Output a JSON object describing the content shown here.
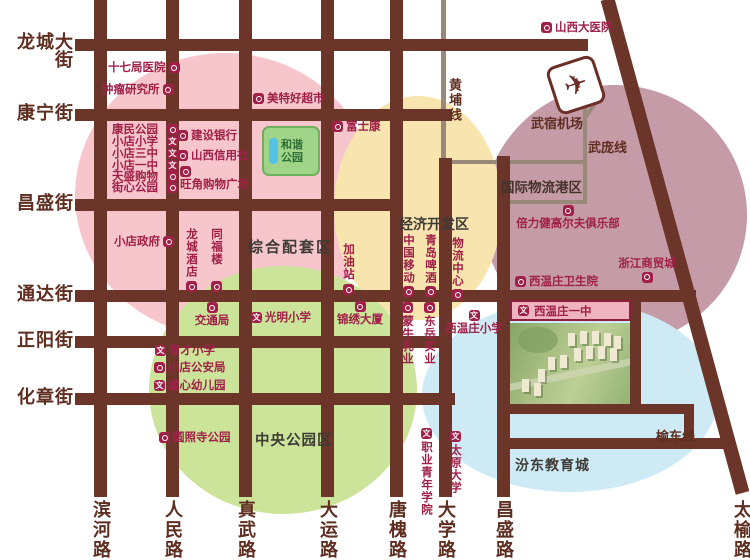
{
  "streets_left": [
    {
      "label": "龙城大街"
    },
    {
      "label": "康宁街"
    },
    {
      "label": "昌盛街"
    },
    {
      "label": "通达街"
    },
    {
      "label": "正阳街"
    },
    {
      "label": "化章街"
    }
  ],
  "roads_bottom": [
    {
      "label": "滨河路"
    },
    {
      "label": "人民路"
    },
    {
      "label": "真武路"
    },
    {
      "label": "大运路"
    },
    {
      "label": "唐槐路"
    },
    {
      "label": "大学路"
    },
    {
      "label": "昌盛路"
    },
    {
      "label": "太榆路"
    }
  ],
  "lines": {
    "huangpu": "黄埔线",
    "wupang": "武庞线",
    "yudong": "榆东线"
  },
  "airport": {
    "label": "武宿机场",
    "icon": "airplane-icon"
  },
  "zones": {
    "composite": {
      "title": "综合配套区",
      "color": "#f7c6cd"
    },
    "economic": {
      "title": "经济开发区",
      "color": "#f7e4ae"
    },
    "logistics": {
      "title": "国际物流港区",
      "color": "#c49ba6"
    },
    "central_park": {
      "title": "中央公园区",
      "color": "#cbe49a"
    },
    "education": {
      "title": "汾东教育城",
      "color": "#cdeaf5"
    }
  },
  "harmony_park": {
    "label": "和谐公园"
  },
  "banner": {
    "label": "西温庄一中",
    "icon": "school-icon"
  },
  "pois": [
    {
      "label": "山西大医院",
      "icon": "hospital-icon"
    },
    {
      "label": "十七局医院",
      "icon": "hospital-icon"
    },
    {
      "label": "肿瘤研究所",
      "icon": "hospital-icon"
    },
    {
      "label": "康民公园",
      "icon": "park-icon"
    },
    {
      "label": "小店小学",
      "icon": "school-icon"
    },
    {
      "label": "小店三中",
      "icon": "school-icon"
    },
    {
      "label": "小店一中",
      "icon": "school-icon"
    },
    {
      "label": "天盛购物",
      "icon": "shopping-icon"
    },
    {
      "label": "街心公园",
      "icon": "park-icon"
    },
    {
      "label": "建设银行",
      "icon": "bank-icon"
    },
    {
      "label": "山西信用社",
      "icon": "bank-icon"
    },
    {
      "label": "旺角购物广场",
      "icon": "shopping-icon"
    },
    {
      "label": "美特好超市",
      "icon": "supermarket-icon"
    },
    {
      "label": "富士康",
      "icon": "company-icon"
    },
    {
      "label": "小店政府",
      "icon": "government-icon"
    },
    {
      "label": "龙城酒店",
      "icon": "hotel-icon"
    },
    {
      "label": "同福楼",
      "icon": "restaurant-icon"
    },
    {
      "label": "加油站",
      "icon": "gas-station-icon"
    },
    {
      "label": "中国移动",
      "icon": "company-icon"
    },
    {
      "label": "青岛啤酒",
      "icon": "company-icon"
    },
    {
      "label": "物流中心",
      "icon": "logistics-icon"
    },
    {
      "label": "倍力健高尔夫俱乐部",
      "icon": "golf-icon"
    },
    {
      "label": "浙江商贸城",
      "icon": "market-icon"
    },
    {
      "label": "西温庄卫生院",
      "icon": "clinic-icon"
    },
    {
      "label": "交通局",
      "icon": "bureau-icon"
    },
    {
      "label": "光明小学",
      "icon": "school-icon"
    },
    {
      "label": "锦绣大厦",
      "icon": "building-icon"
    },
    {
      "label": "育才小学",
      "icon": "school-icon"
    },
    {
      "label": "小店公安局",
      "icon": "police-icon"
    },
    {
      "label": "童心幼儿园",
      "icon": "school-icon"
    },
    {
      "label": "圆照寺公园",
      "icon": "park-icon"
    },
    {
      "label": "蒙牛乳业",
      "icon": "company-icon"
    },
    {
      "label": "东岳实业",
      "icon": "company-icon"
    },
    {
      "label": "西温庄小学",
      "icon": "school-icon"
    },
    {
      "label": "职业青年学院",
      "icon": "school-icon"
    },
    {
      "label": "太原大学",
      "icon": "school-icon"
    }
  ],
  "colors": {
    "road": "#6b3629",
    "road_minor": "#99897b",
    "street_text": "#5e2e21",
    "poi_accent": "#a02048",
    "zone_pink": "#f7c6cd",
    "zone_yellow": "#f7e4ae",
    "zone_mauve": "#c49ba6",
    "zone_green": "#cbe49a",
    "zone_blue": "#cdeaf5"
  }
}
